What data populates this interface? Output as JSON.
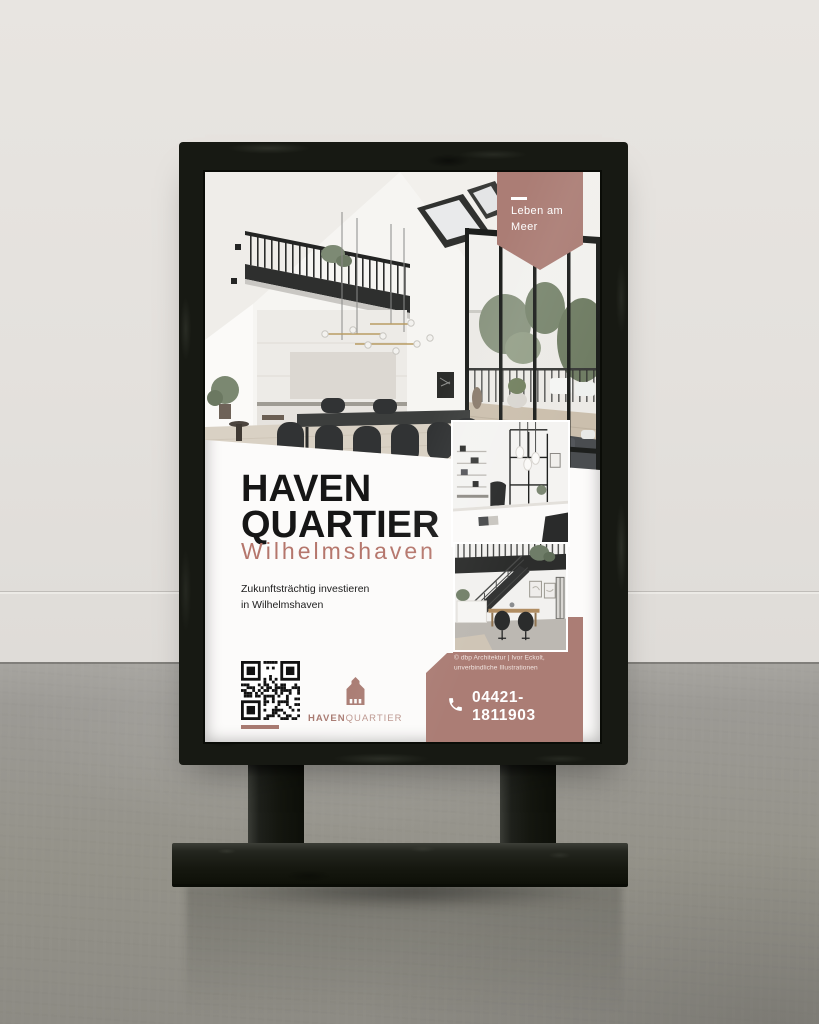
{
  "poster": {
    "badge": {
      "line1": "Leben am",
      "line2": "Meer"
    },
    "title": {
      "line1": "HAVEN",
      "line2": "QUARTIER"
    },
    "subtitle": "Wilhelmshaven",
    "tagline": {
      "line1": "Zukunftsträchtig investieren",
      "line2": "in Wilhelmshaven"
    },
    "logo": {
      "word_bold": "HAVEN",
      "word_light": "QUARTIER"
    },
    "phone": "04421-1811903",
    "credit": {
      "line1": "© dbp Architektur | Ivor Eckolt,",
      "line2": "unverbindliche Illustrationen"
    },
    "colors": {
      "accent": "#ab7d75",
      "accent_deep": "#a87a71",
      "subtitle_text": "#b5766c",
      "title_text": "#161616",
      "phone_text": "#ffffff"
    }
  }
}
